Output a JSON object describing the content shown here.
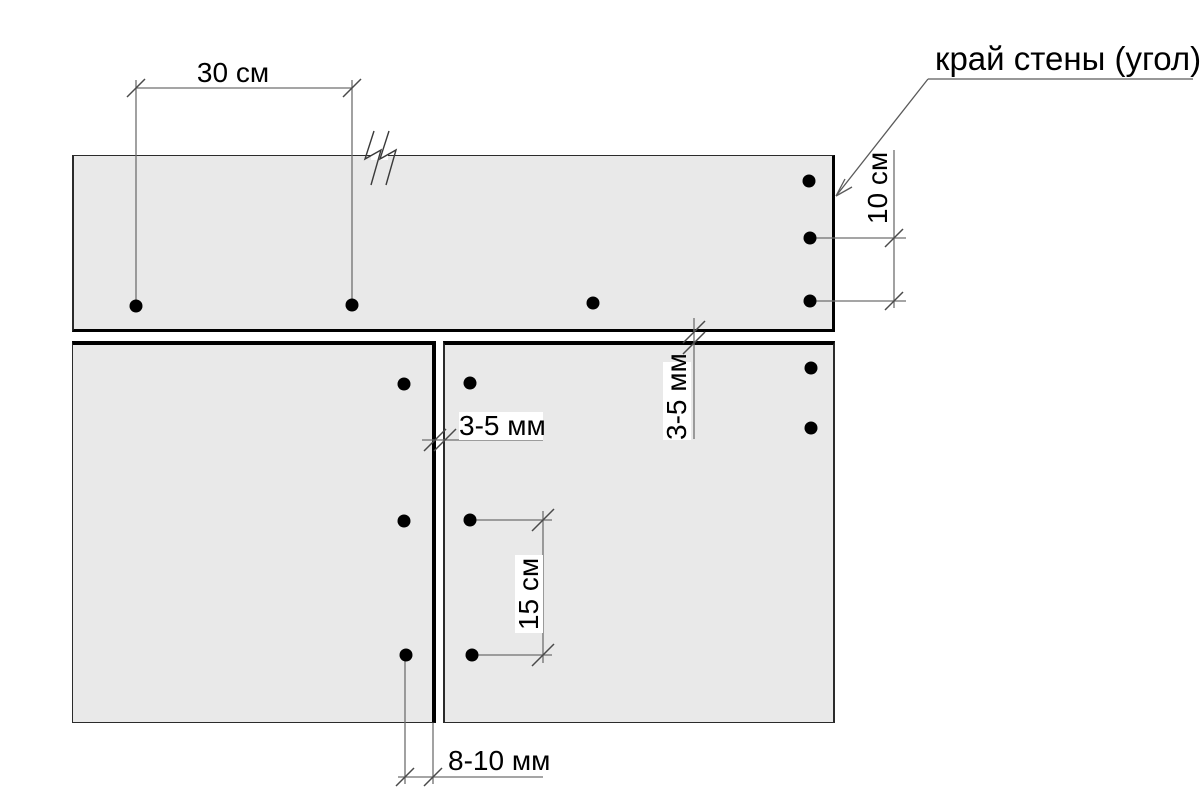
{
  "diagram": {
    "wall_edge_label": "край стены (угол)",
    "dim_screw_spacing_h": "30 см",
    "dim_corner_offset": "10 см",
    "dim_joint_gap_vertical": "3-5 мм",
    "dim_joint_gap_horizontal": "3-5 мм",
    "dim_screw_spacing_v": "15 см",
    "dim_screw_edge_offset": "8-10 мм"
  },
  "colors": {
    "panel_fill": "#e9e9e9",
    "panel_border": "#2b2b2b",
    "thick_edge": "#000000",
    "dim_line": "#6f6f6f",
    "tick": "#4a4a4a",
    "screw": "#000000",
    "text": "#000000",
    "label_background": "#ffffff"
  }
}
